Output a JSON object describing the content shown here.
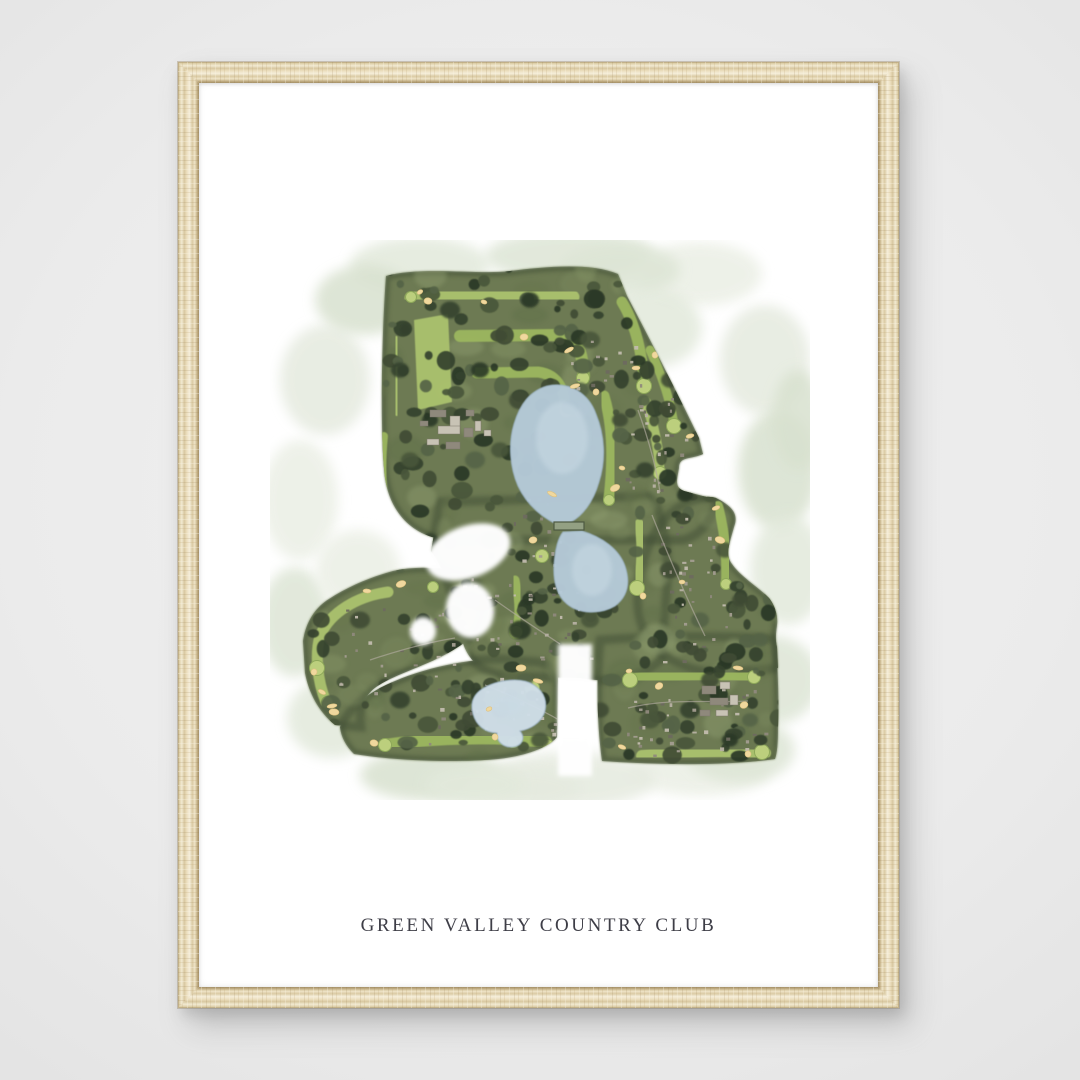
{
  "print": {
    "title": "GREEN VALLEY COUNTRY CLUB"
  },
  "scene": {
    "wall_color": "#ebebeb",
    "frame_wood_base": "#e7dabb",
    "frame_wood_light": "#f5eeda",
    "frame_wood_dark": "#a28e66",
    "paper_color": "#ffffff",
    "title_color": "#3e3e47"
  },
  "artwork": {
    "kind": "watercolor-aerial-golf-course-map",
    "w": 540,
    "h": 560,
    "palette": {
      "base": "#6d7a52",
      "edge": "#404d36",
      "wash": [
        "#e2e9db",
        "#dde5d5",
        "#ebefe5",
        "#e5eadf",
        "#d8e1cf"
      ],
      "mottle": [
        "#7d8b60",
        "#5f6f49",
        "#8a9a6b",
        "#66754e",
        "#93a173"
      ],
      "trees": [
        "#36432f",
        "#2c3928",
        "#4a573b",
        "#3f4c35",
        "#556347"
      ],
      "fairway": "#9cb75f",
      "fairwayLight": "#abc26e",
      "green": "#bccf7d",
      "greenEdge": "#8ea85a",
      "pond": "#b5cad8",
      "pondLight": "#c9dae4",
      "pondPale": "#cfdde8",
      "pondEdge": "#9db4c5",
      "bunker": "#f0d89e",
      "bunkerEdge": "#ddc07e",
      "building": "#c8c3b5",
      "buildingDark": "#8f897c",
      "speck": [
        "#a39d90",
        "#8f897c",
        "#b7b1a3",
        "#6e6a5f",
        "#c2bcae"
      ],
      "road": "#b0aa9e",
      "dam": "#93a083",
      "damEdge": "#4e5a42",
      "white": "#ffffff"
    },
    "wash_blobs": [
      [
        150,
        25,
        70,
        28
      ],
      [
        300,
        16,
        85,
        26
      ],
      [
        430,
        34,
        62,
        32
      ],
      [
        495,
        120,
        45,
        55
      ],
      [
        508,
        230,
        40,
        60
      ],
      [
        518,
        330,
        38,
        55
      ],
      [
        500,
        440,
        50,
        45
      ],
      [
        430,
        530,
        70,
        26
      ],
      [
        300,
        540,
        85,
        28
      ],
      [
        160,
        535,
        70,
        26
      ],
      [
        62,
        478,
        45,
        40
      ],
      [
        25,
        382,
        35,
        55
      ],
      [
        30,
        260,
        38,
        60
      ],
      [
        55,
        140,
        45,
        55
      ],
      [
        95,
        60,
        50,
        35
      ],
      [
        380,
        88,
        52,
        40
      ],
      [
        470,
        510,
        55,
        33
      ],
      [
        88,
        330,
        42,
        40
      ],
      [
        250,
        548,
        60,
        20
      ],
      [
        528,
        180,
        26,
        50
      ],
      [
        205,
        545,
        50,
        20
      ],
      [
        350,
        30,
        60,
        26
      ]
    ],
    "silhouette": [
      "M116,36 C150,26 210,35 240,31 C272,27 320,22 348,34 L357,56 C374,88 404,146 429,198 L433,214 C420,220 409,216 409,228 C407,240 404,247 414,251 L448,260 C440,285 428,296 413,300 L180,300 C140,298 116,268 114,228 C110,180 112,90 116,36 Z",
      "M170,262 L382,256 C396,282 400,320 396,360 L391,420 C371,438 341,444 311,438 L241,436 C211,434 196,420 191,395 C187,370 176,330 161,311 Z",
      "M446,258 C462,266 469,274 464,287 C459,305 455,315 462,324 C470,336 488,347 499,358 C505,366 508,375 507,385 C506,393 505,399 507,407 L508,428 L462,432 C432,435 406,426 388,410 C372,395 364,372 369,342 C374,312 384,287 401,273 C416,261 434,254 446,258 Z",
      "M330,400 C395,395 460,396 505,399 C508,425 509,462 508,488 C508,503 507,513 505,519 C455,526 390,525 332,521 C327,485 326,440 330,400 Z",
      "M70,487 C78,470 92,458 110,448 C145,430 192,419 232,419 L267,422 C281,424 288,431 288,440 L287,497 C278,508 255,516 228,519 C185,523 128,521 84,514 C76,506 71,497 70,487 Z",
      "M33,401 C36,381 46,367 59,359 C79,346 101,337 123,331 C146,326 171,327 191,333 C206,338 213,349 213,363 C213,381 205,396 188,407 C161,425 126,433 106,447 C96,454 91,465 90,477 L91,487 L65,485 C48,471 39,453 35,433 Z"
    ],
    "carves": [
      {
        "cx": 198,
        "cy": 312,
        "rx": 44,
        "ry": 26,
        "rot": -20
      },
      {
        "cx": 200,
        "cy": 370,
        "rx": 24,
        "ry": 28,
        "rot": -8
      },
      {
        "cx": 153,
        "cy": 391,
        "rx": 13,
        "ry": 14,
        "rot": 0
      }
    ],
    "carve_rects": [
      [
        288,
        404,
        34,
        132
      ]
    ],
    "mottle_regions": [
      [
        112,
        28,
        330,
        270,
        30
      ],
      [
        150,
        250,
        250,
        190,
        18
      ],
      [
        32,
        328,
        185,
        160,
        14
      ],
      [
        95,
        425,
        215,
        98,
        12
      ],
      [
        338,
        398,
        170,
        125,
        14
      ],
      [
        360,
        250,
        150,
        185,
        12
      ]
    ],
    "range_poly": "M144,80 L178,74 L182,162 L148,170 Z",
    "fairway_paths": [
      [
        "M141,58 C190,52 250,52 303,57",
        13
      ],
      [
        "M190,96 L288,95 C304,97 310,107 312,120 L314,136",
        12
      ],
      [
        "M207,133 L268,132 C284,134 291,144 294,157 L296,170",
        11
      ],
      [
        "M126,100 L127,172",
        8
      ],
      [
        "M114,196 C111,226 112,258 119,289",
        8
      ],
      [
        "M352,62 C362,78 370,102 373,131 L374,144",
        11
      ],
      [
        "M376,162 C384,186 389,210 390,231",
        10
      ],
      [
        "M334,156 C342,182 344,216 339,258",
        11
      ],
      [
        "M272,262 L272,313",
        10
      ],
      [
        "M369,284 C373,306 372,326 367,346",
        10
      ],
      [
        "M448,266 C455,292 457,316 456,342",
        10
      ],
      [
        "M363,439 C400,434 450,433 484,436",
        12
      ],
      [
        "M372,516 C410,511 455,510 495,513",
        12
      ],
      [
        "M490,442 L490,508",
        9
      ],
      [
        "M115,505 C160,498 225,496 276,502",
        12
      ],
      [
        "M118,352 C88,356 60,372 50,396 C45,414 47,440 56,462",
        11
      ],
      [
        "M245,340 C250,362 250,377 246,391",
        9
      ],
      [
        "M380,110 C392,135 400,160 404,184",
        9
      ],
      [
        "M331,412 L331,512",
        8
      ]
    ],
    "greens": [
      [
        141,
        57
      ],
      [
        296,
        171
      ],
      [
        374,
        146
      ],
      [
        339,
        260
      ],
      [
        272,
        316
      ],
      [
        367,
        348
      ],
      [
        456,
        344
      ],
      [
        484,
        437
      ],
      [
        492,
        512
      ],
      [
        278,
        505
      ],
      [
        115,
        505
      ],
      [
        47,
        428
      ],
      [
        163,
        347
      ],
      [
        246,
        392
      ],
      [
        404,
        186
      ],
      [
        121,
        289
      ],
      [
        313,
        138
      ],
      [
        360,
        440
      ],
      [
        243,
        502
      ],
      [
        390,
        233
      ],
      [
        262,
        448
      ],
      [
        57,
        462
      ]
    ],
    "tree_regions": [
      [
        112,
        28,
        320,
        100,
        40
      ],
      [
        112,
        115,
        125,
        150,
        28
      ],
      [
        235,
        100,
        180,
        135,
        30
      ],
      [
        345,
        115,
        100,
        160,
        26
      ],
      [
        150,
        252,
        150,
        115,
        24
      ],
      [
        215,
        325,
        130,
        115,
        26
      ],
      [
        365,
        255,
        145,
        180,
        30
      ],
      [
        32,
        330,
        185,
        160,
        30
      ],
      [
        95,
        425,
        215,
        95,
        28
      ],
      [
        338,
        398,
        175,
        125,
        36
      ]
    ],
    "extra_trees": [
      [
        180,
        70,
        10
      ],
      [
        260,
        60,
        9
      ],
      [
        320,
        100,
        10
      ],
      [
        250,
        160,
        11
      ],
      [
        205,
        220,
        10
      ],
      [
        290,
        320,
        9
      ],
      [
        250,
        390,
        11
      ],
      [
        200,
        360,
        10
      ],
      [
        90,
        380,
        10
      ],
      [
        150,
        400,
        9
      ],
      [
        130,
        460,
        10
      ],
      [
        230,
        470,
        9
      ],
      [
        270,
        500,
        9
      ],
      [
        400,
        330,
        10
      ],
      [
        430,
        380,
        9
      ],
      [
        420,
        470,
        10
      ],
      [
        460,
        500,
        8
      ],
      [
        380,
        480,
        10
      ],
      [
        400,
        140,
        9
      ],
      [
        370,
        60,
        8
      ],
      [
        300,
        220,
        9
      ],
      [
        220,
        300,
        10
      ],
      [
        320,
        380,
        9
      ],
      [
        440,
        440,
        9
      ],
      [
        480,
        480,
        8
      ],
      [
        160,
        300,
        8
      ],
      [
        210,
        130,
        9
      ],
      [
        140,
        220,
        9
      ],
      [
        330,
        470,
        9
      ],
      [
        255,
        440,
        8
      ],
      [
        375,
        230,
        9
      ],
      [
        415,
        255,
        8
      ],
      [
        455,
        310,
        9
      ],
      [
        470,
        360,
        8
      ],
      [
        490,
        400,
        8
      ],
      [
        130,
        130,
        9
      ],
      [
        160,
        180,
        8
      ],
      [
        230,
        210,
        9
      ],
      [
        350,
        180,
        8
      ],
      [
        310,
        150,
        9
      ]
    ],
    "speck_regions": [
      [
        180,
        335,
        140,
        90,
        40
      ],
      [
        155,
        435,
        140,
        80,
        32
      ],
      [
        355,
        150,
        60,
        100,
        24
      ],
      [
        388,
        272,
        75,
        150,
        36
      ],
      [
        355,
        445,
        140,
        70,
        36
      ],
      [
        65,
        360,
        120,
        95,
        26
      ],
      [
        240,
        255,
        55,
        75,
        14
      ],
      [
        300,
        100,
        70,
        55,
        16
      ]
    ],
    "ponds": [
      {
        "d": "M277,146 C300,141 319,154 326,174 C335,196 336,220 329,242 C323,263 312,276 301,282 L286,284 C272,277 257,265 248,246 C240,228 238,204 244,184 C250,164 260,151 277,146 Z",
        "fill": "pond"
      },
      {
        "d": "M293,292 L312,291 C332,297 349,309 355,326 C361,344 357,357 345,366 C330,375 309,374 297,364 C287,356 283,341 284,325 C285,311 288,298 293,292 Z",
        "fill": "pond"
      },
      {
        "d": "M212,449 C228,439 252,437 264,445 C275,452 278,463 274,474 C270,483 261,489 250,491 C256,498 252,506 243,507 C233,508 226,501 227,493 C215,493 206,485 203,474 C200,463 203,455 212,449 Z",
        "fill": "pondPale"
      }
    ],
    "pond_highlights": [
      [
        292,
        198,
        26,
        36
      ],
      [
        322,
        330,
        20,
        26
      ],
      [
        238,
        466,
        16,
        10
      ]
    ],
    "dam": {
      "x": 284,
      "y": 282,
      "w": 30,
      "h": 8
    },
    "bunkers": [
      [
        150,
        52
      ],
      [
        158,
        61
      ],
      [
        305,
        146
      ],
      [
        326,
        152
      ],
      [
        366,
        128
      ],
      [
        345,
        248
      ],
      [
        352,
        228
      ],
      [
        263,
        300
      ],
      [
        282,
        254
      ],
      [
        373,
        356
      ],
      [
        446,
        268
      ],
      [
        450,
        300
      ],
      [
        359,
        431
      ],
      [
        389,
        446
      ],
      [
        468,
        428
      ],
      [
        478,
        514
      ],
      [
        352,
        507
      ],
      [
        251,
        428
      ],
      [
        219,
        469
      ],
      [
        104,
        503
      ],
      [
        62,
        466
      ],
      [
        44,
        432
      ],
      [
        97,
        351
      ],
      [
        131,
        344
      ],
      [
        214,
        62
      ],
      [
        254,
        97
      ],
      [
        299,
        110
      ],
      [
        385,
        115
      ],
      [
        420,
        196
      ],
      [
        300,
        478
      ],
      [
        412,
        342
      ],
      [
        474,
        465
      ],
      [
        268,
        441
      ],
      [
        225,
        497
      ],
      [
        52,
        452
      ],
      [
        64,
        472
      ]
    ],
    "clubhouse": [
      [
        160,
        170,
        16,
        7
      ],
      [
        180,
        176,
        10,
        12
      ],
      [
        196,
        170,
        8,
        6
      ],
      [
        168,
        186,
        22,
        8
      ],
      [
        194,
        188,
        9,
        9
      ],
      [
        157,
        199,
        12,
        6
      ],
      [
        176,
        202,
        14,
        7
      ],
      [
        205,
        181,
        6,
        10
      ],
      [
        150,
        181,
        8,
        5
      ],
      [
        214,
        190,
        7,
        6
      ],
      [
        432,
        446,
        14,
        8
      ],
      [
        450,
        442,
        10,
        7
      ],
      [
        440,
        458,
        18,
        7
      ],
      [
        460,
        455,
        8,
        10
      ],
      [
        430,
        470,
        10,
        6
      ],
      [
        446,
        470,
        12,
        6
      ]
    ],
    "roads": [
      "M225,360 C250,378 272,392 290,404",
      "M382,275 C398,315 415,355 435,396",
      "M358,468 C398,458 440,463 478,461",
      "M100,420 C130,410 160,402 185,398",
      "M215,445 C248,458 276,472 296,484",
      "M368,170 C378,198 386,226 390,252"
    ]
  }
}
